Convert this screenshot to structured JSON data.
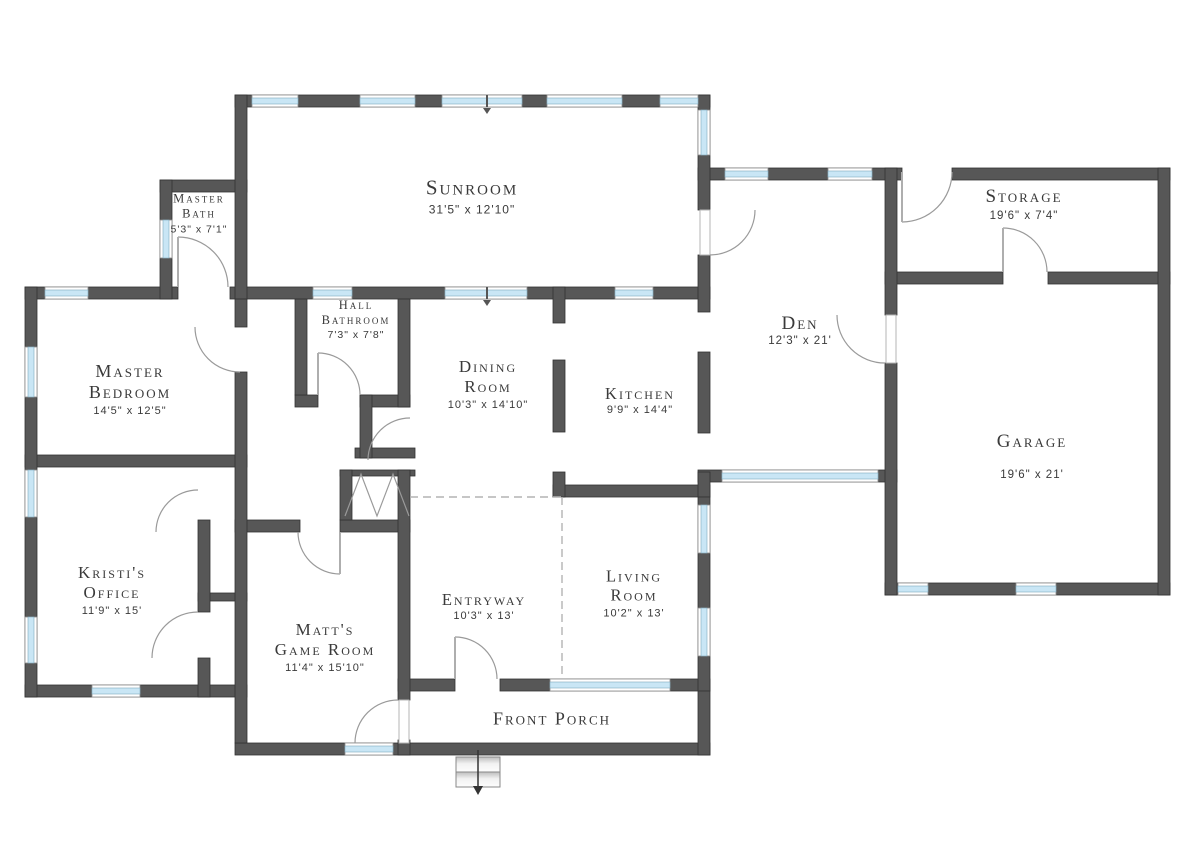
{
  "floor_plan": {
    "colors": {
      "wall": "#575757",
      "window_glass": "#c9e6f5",
      "text": "#3a3a3a",
      "door_arc": "#9a9a9a"
    },
    "rooms": [
      {
        "id": "sunroom",
        "lines": [
          "Sunroom"
        ],
        "dims": "31'5\" x 12'10\"",
        "cx": 472,
        "cy": 196,
        "name_size": 21,
        "dims_size": 12,
        "gap": 2
      },
      {
        "id": "master-bath",
        "lines": [
          "Master",
          "Bath"
        ],
        "dims": "5'3\" x 7'1\"",
        "cx": 199,
        "cy": 213,
        "name_size": 12.5,
        "dims_size": 10.5,
        "gap": 2
      },
      {
        "id": "storage",
        "lines": [
          "Storage"
        ],
        "dims": "19'6\" x 7'4\"",
        "cx": 1024,
        "cy": 204,
        "name_size": 19,
        "dims_size": 11.5,
        "gap": 2
      },
      {
        "id": "master-bedroom",
        "lines": [
          "Master",
          "Bedroom"
        ],
        "dims": "14'5\" x 12'5\"",
        "cx": 130,
        "cy": 389,
        "name_size": 18,
        "dims_size": 11,
        "gap": 2
      },
      {
        "id": "hall-bathroom",
        "lines": [
          "Hall",
          "Bathroom"
        ],
        "dims": "7'3\" x 7'8\"",
        "cx": 356,
        "cy": 319,
        "name_size": 12.5,
        "dims_size": 10.5,
        "gap": 1
      },
      {
        "id": "dining-room",
        "lines": [
          "Dining",
          "Room"
        ],
        "dims": "10'3\" x 14'10\"",
        "cx": 488,
        "cy": 384,
        "name_size": 17,
        "dims_size": 11,
        "gap": 2
      },
      {
        "id": "kitchen",
        "lines": [
          "Kitchen"
        ],
        "dims": "9'9\" x 14'4\"",
        "cx": 640,
        "cy": 400,
        "name_size": 16.5,
        "dims_size": 11,
        "gap": 1
      },
      {
        "id": "den",
        "lines": [
          "Den"
        ],
        "dims": "12'3\" x 21'",
        "cx": 800,
        "cy": 330,
        "name_size": 19,
        "dims_size": 11.5,
        "gap": 0
      },
      {
        "id": "garage",
        "lines": [
          "Garage"
        ],
        "dims": "19'6\" x 21'",
        "cx": 1032,
        "cy": 456,
        "name_size": 19,
        "dims_size": 11.5,
        "gap": 16
      },
      {
        "id": "kristis-office",
        "lines": [
          "Kristi's",
          "Office"
        ],
        "dims": "11'9\" x 15'",
        "cx": 112,
        "cy": 590,
        "name_size": 17,
        "dims_size": 11,
        "gap": 2
      },
      {
        "id": "matts-game-room",
        "lines": [
          "Matt's",
          "Game Room"
        ],
        "dims": "11'4\" x 15'10\"",
        "cx": 325,
        "cy": 647,
        "name_size": 17,
        "dims_size": 11,
        "gap": 2
      },
      {
        "id": "entryway",
        "lines": [
          "Entryway"
        ],
        "dims": "10'3\" x 13'",
        "cx": 484,
        "cy": 606,
        "name_size": 16.5,
        "dims_size": 11,
        "gap": 1
      },
      {
        "id": "living-room",
        "lines": [
          "Living",
          "Room"
        ],
        "dims": "10'2\" x 13'",
        "cx": 634,
        "cy": 593,
        "name_size": 16.5,
        "dims_size": 11,
        "gap": 2
      },
      {
        "id": "front-porch",
        "lines": [
          "Front Porch"
        ],
        "dims": null,
        "cx": 552,
        "cy": 719,
        "name_size": 18,
        "dims_size": 11,
        "gap": 0
      }
    ]
  }
}
